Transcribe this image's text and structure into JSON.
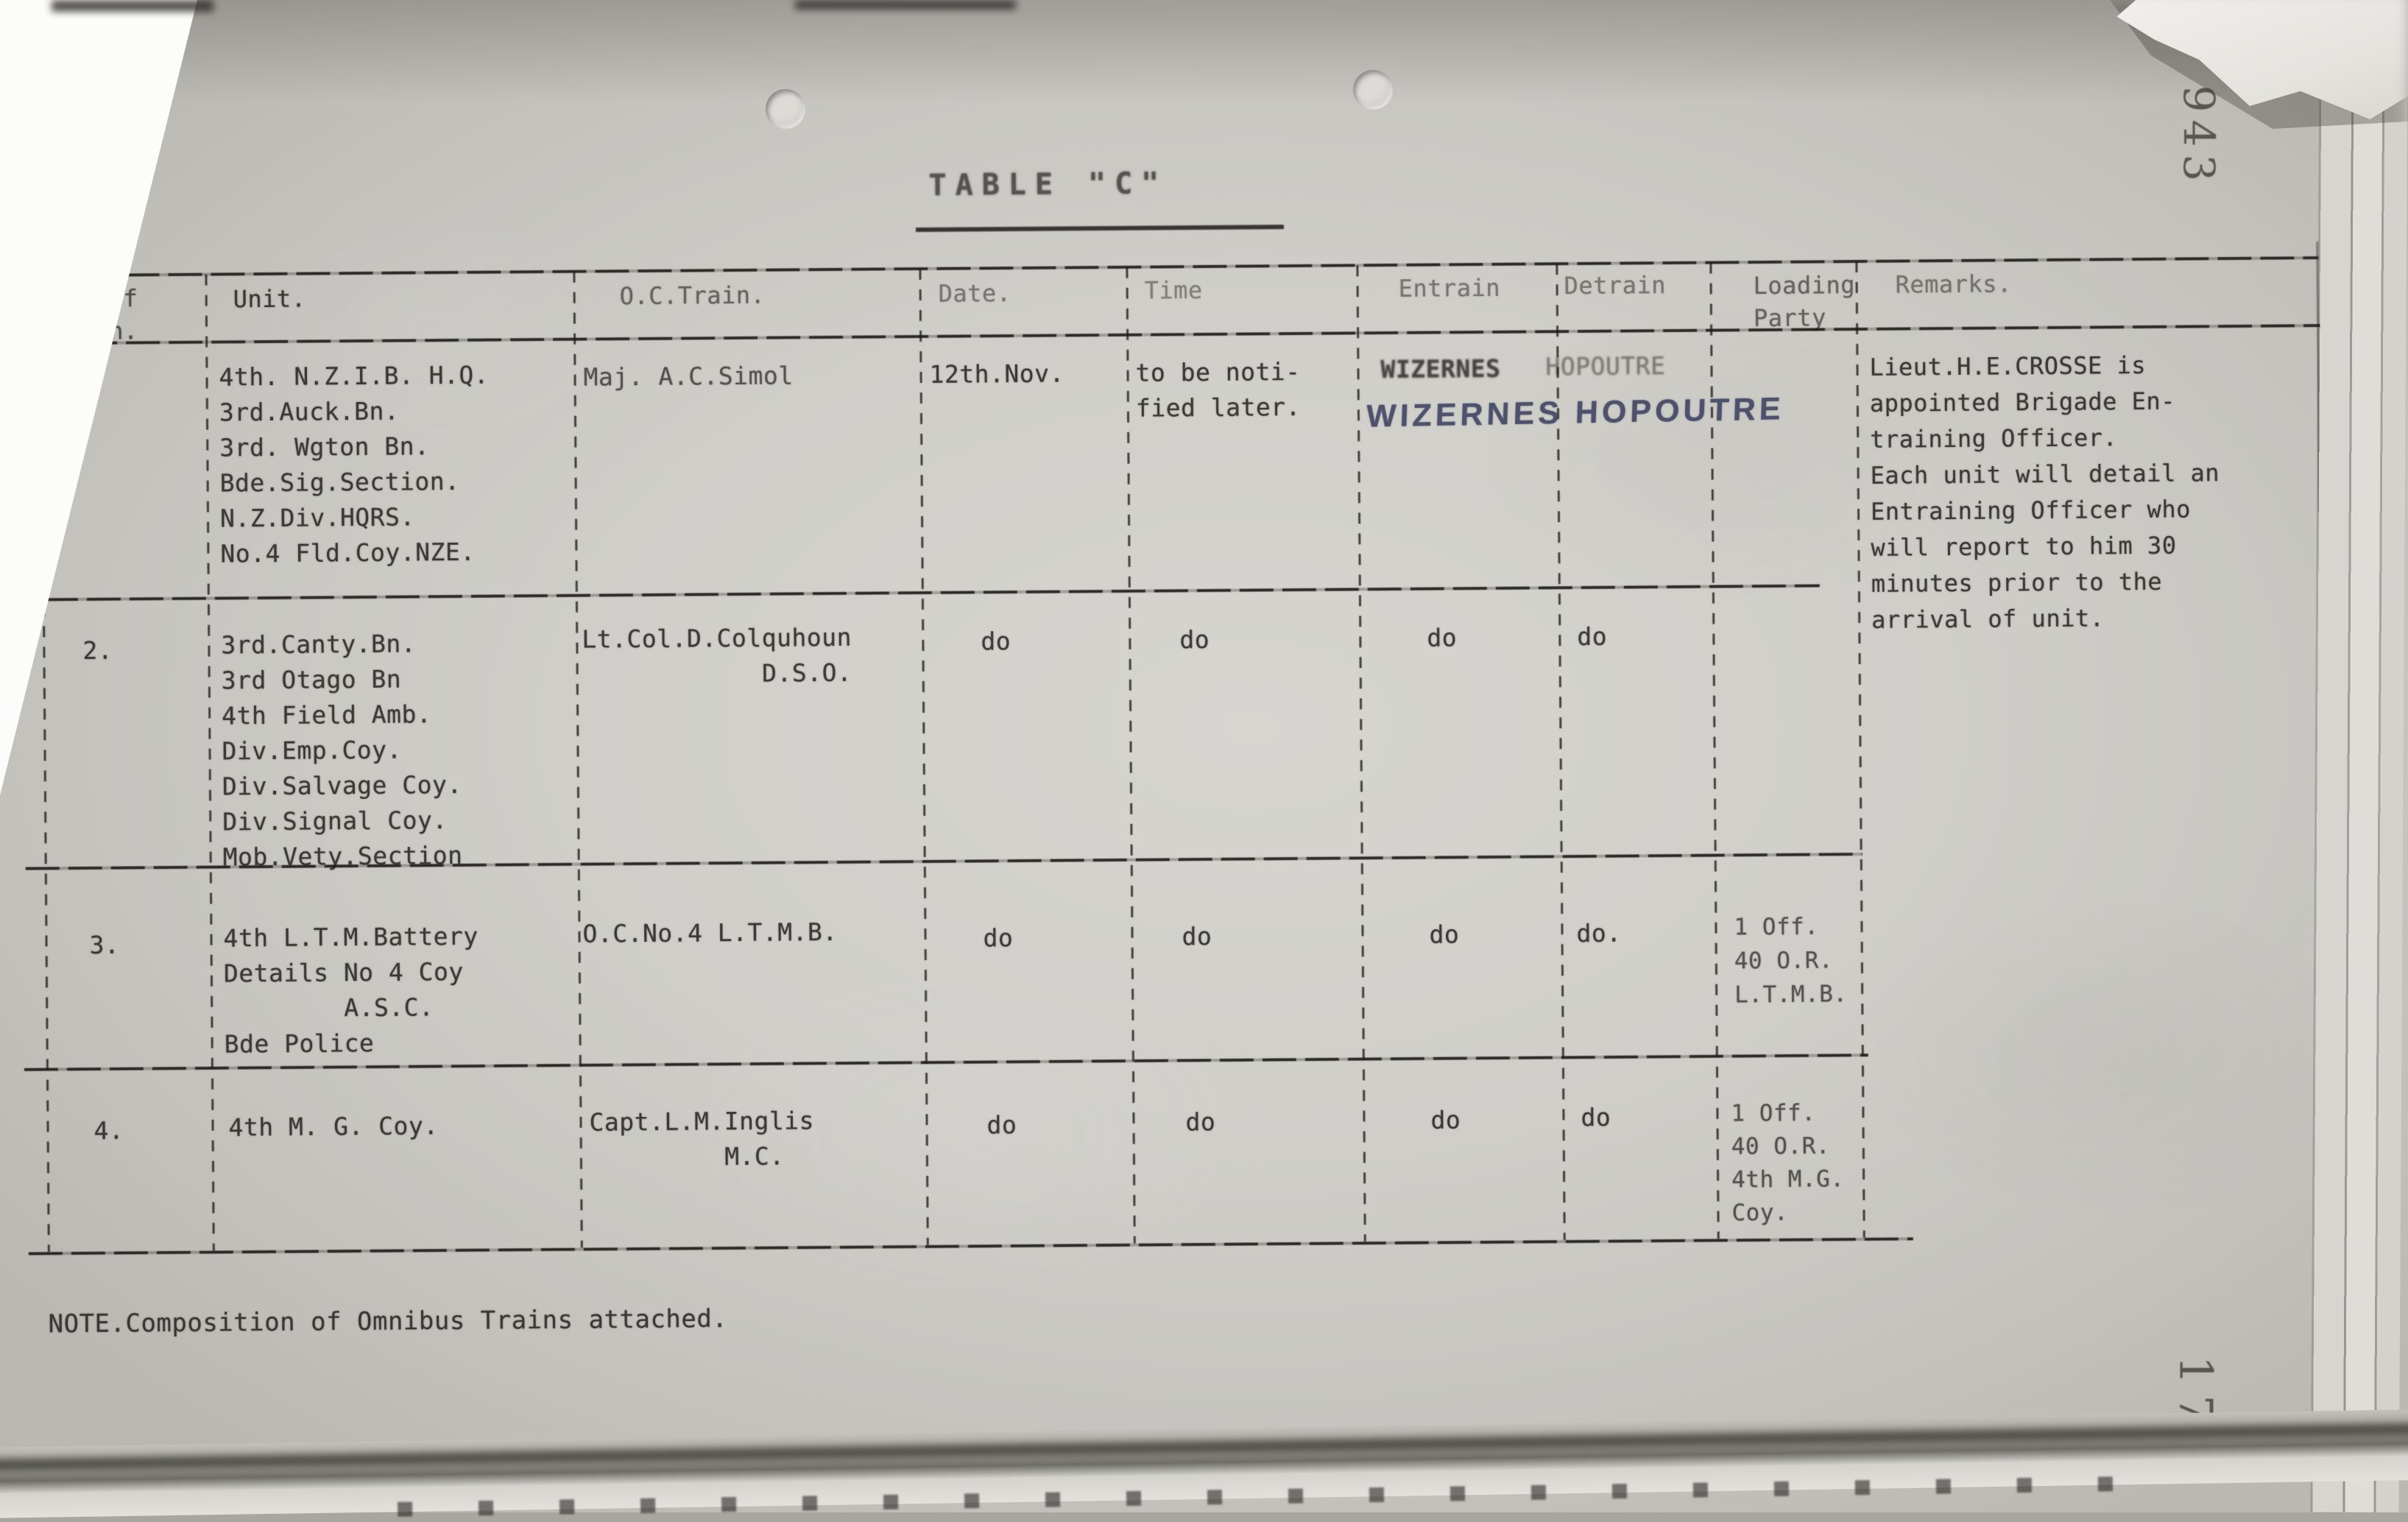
{
  "page": {
    "title": "TABLE \"C\"",
    "note": "NOTE.Composition of Omnibus Trains attached.",
    "stamp_top": "943",
    "stamp_bottom": "17"
  },
  "colors": {
    "paper": "#cfcec9",
    "typed_ink": "#21201c",
    "handwriting_ink": "#3c4160"
  },
  "table": {
    "headers": {
      "no": "No. of\nTrain.",
      "unit": "Unit.",
      "oc": "O.C.Train.",
      "date": "Date.",
      "time": "Time",
      "entrain": "Entrain",
      "detrain": "Detrain",
      "loading": "Loading\nParty",
      "remarks": "Remarks."
    },
    "rows": [
      {
        "no": "1.",
        "unit": "4th. N.Z.I.B. H.Q.\n3rd.Auck.Bn.\n3rd. Wgton Bn.\nBde.Sig.Section.\nN.Z.Div.HQRS.\nNo.4 Fld.Coy.NZE.",
        "oc": "Maj. A.C.Simol",
        "date": "12th.Nov.",
        "time": "to be noti-\nfied later.",
        "entrain_typed": "WIZERNES",
        "detrain_typed": "HOPOUTRE",
        "handwritten": "WIZERNES HOPOUTRE",
        "remarks": "Lieut.H.E.CROSSE is\nappointed Brigade En-\ntraining Officer.\nEach unit will detail an\nEntraining Officer who\nwill report to him 30\nminutes prior to the\narrival of unit."
      },
      {
        "no": "2.",
        "unit": "3rd.Canty.Bn.\n3rd Otago Bn\n4th Field Amb.\nDiv.Emp.Coy.\nDiv.Salvage Coy.\nDiv.Signal Coy.\nMob.Vety.Section",
        "oc": "Lt.Col.D.Colquhoun\n            D.S.O.",
        "date": "do",
        "time": "do",
        "entrain": "do",
        "detrain": "do"
      },
      {
        "no": "3.",
        "unit": "4th L.T.M.Battery\nDetails No 4 Coy\n        A.S.C.\nBde Police",
        "oc": "O.C.No.4 L.T.M.B.",
        "date": "do",
        "time": "do",
        "entrain": "do",
        "detrain": "do.",
        "loading": "1 Off.\n40 O.R.\nL.T.M.B."
      },
      {
        "no": "4.",
        "unit": "4th M. G. Coy.",
        "oc": "Capt.L.M.Inglis\n         M.C.",
        "date": "do",
        "time": "do",
        "entrain": "do",
        "detrain": "do",
        "loading": "1 Off.\n40 O.R.\n4th M.G.\nCoy."
      }
    ]
  }
}
